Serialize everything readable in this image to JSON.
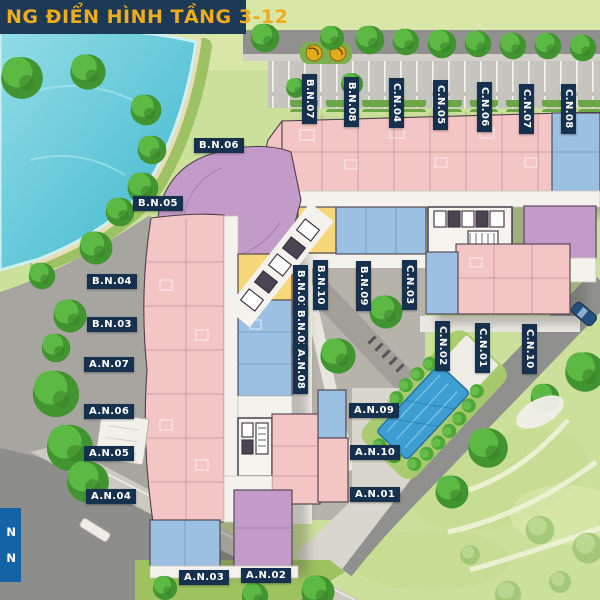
{
  "title": {
    "text": "NG ĐIỂN HÌNH TẦNG 3-12"
  },
  "legend": {
    "lines": [
      {
        "text": "N"
      },
      {
        "text": "N"
      }
    ]
  },
  "labels": [
    {
      "text": "B.N.07"
    },
    {
      "text": "B.N.08"
    },
    {
      "text": "C.N.04"
    },
    {
      "text": "C.N.05"
    },
    {
      "text": "C.N.06"
    },
    {
      "text": "C.N.07"
    },
    {
      "text": "C.N.08"
    },
    {
      "text": "B.N.06"
    },
    {
      "text": "B.N.05"
    },
    {
      "text": "B.N.04"
    },
    {
      "text": "B.N.03"
    },
    {
      "text": "A.N.07"
    },
    {
      "text": "A.N.06"
    },
    {
      "text": "A.N.05"
    },
    {
      "text": "A.N.04"
    },
    {
      "text": "B.N.01"
    },
    {
      "text": "B.N.10"
    },
    {
      "text": "B.N.09"
    },
    {
      "text": "C.N.03"
    },
    {
      "text": "B.N.02"
    },
    {
      "text": "A.N.08"
    },
    {
      "text": "C.N.02"
    },
    {
      "text": "C.N.01"
    },
    {
      "text": "C.N.10"
    },
    {
      "text": "A.N.09"
    },
    {
      "text": "A.N.10"
    },
    {
      "text": "A.N.01"
    },
    {
      "text": "A.N.03"
    },
    {
      "text": "A.N.02"
    }
  ],
  "colors": {
    "banner_bg": "#1c3a55",
    "banner_text": "#efac1e",
    "tag_bg": "#16314d",
    "tag_text": "#ffffff",
    "legend_bg": "#1463a6",
    "unit_pink": "#f3c5c5",
    "unit_blue": "#9cc0e2",
    "unit_purple": "#c29bc8",
    "unit_yellow": "#f6d878",
    "corridor": "#f4f2ec",
    "lake": "#54c3d6",
    "pool": "#3e9ed2",
    "grass": "#cbe09a",
    "road": "#90918f"
  }
}
